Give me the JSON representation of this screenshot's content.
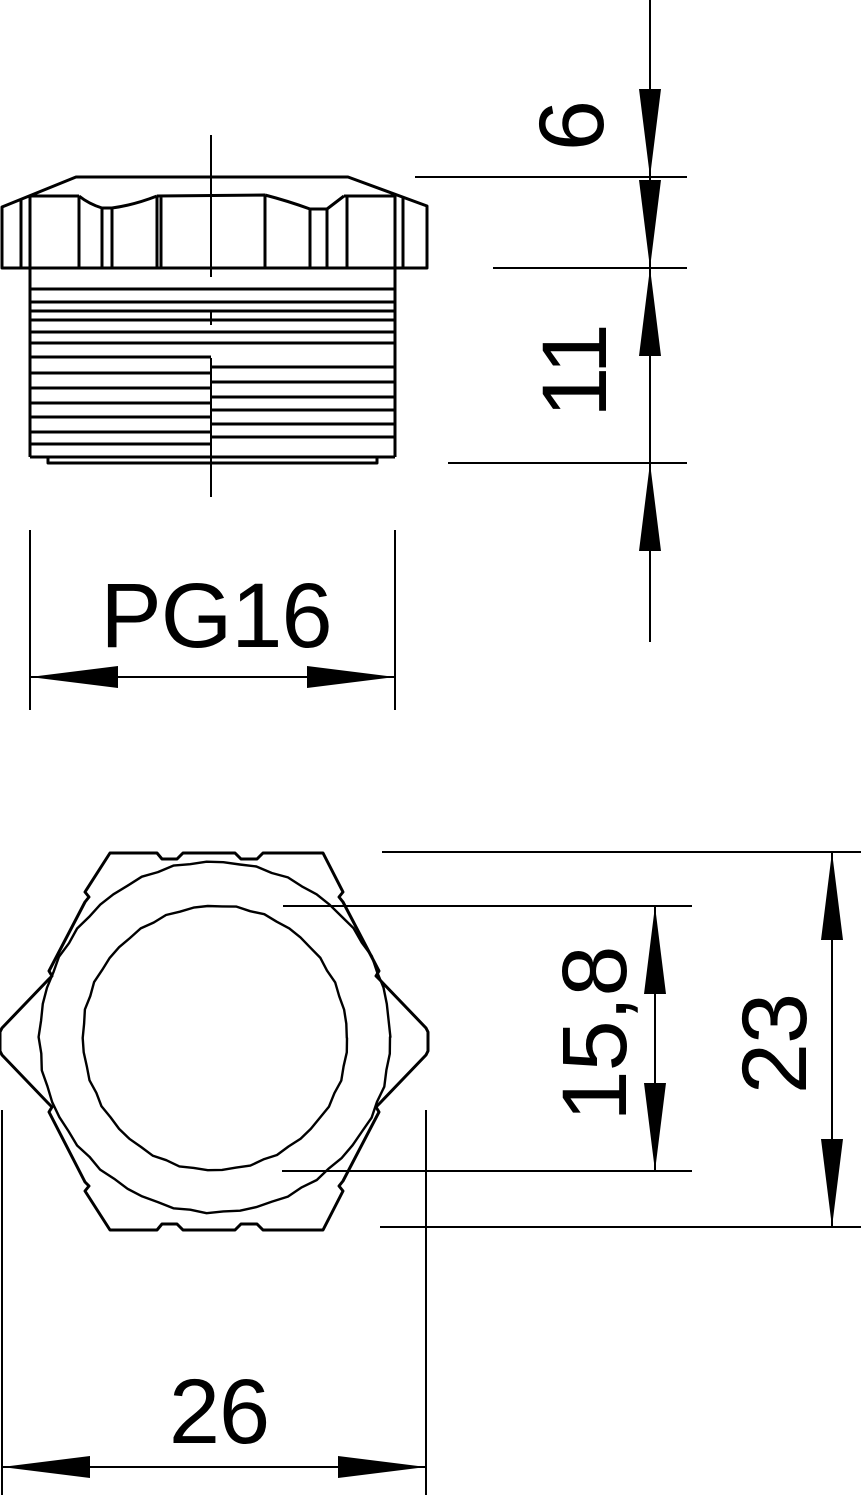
{
  "page": {
    "background": "#ffffff",
    "line_color": "#000000"
  },
  "drawing": {
    "labels": {
      "thread_size": "PG16",
      "head_height": "6",
      "thread_length": "11",
      "inner_diameter": "15,8",
      "across_flats": "23",
      "outer_diameter": "26"
    }
  },
  "geometry": {
    "arrow": {
      "length": 88,
      "half_width": 11
    },
    "side_view": {
      "head_outline": "M2,207 L76,177 L348,177 L427,206 L427,268 L2,268 Z",
      "crown_detail": "M21,200 L21,268 M30,196 L30,268 M30,196 L79,196 M79,196 L79,268 M79,196 Q89,204 102,208 M102,208 L102,268 M102,208 L112,208 M112,208 L112,268 M112,208 Q134,205 157,196 M157,196 L157,268 M161,196 L161,268 M157,196 L265,195 M265,195 L265,268 M265,195 Q288,201 310,209 M310,209 L310,268 M310,209 L327,209 M327,209 L327,268 M327,209 L344,196 M344,196 L347,196 M347,196 L347,268 M344,196 L395,196 M395,194 L395,268 M403,197 L403,268",
      "body_outline": "M30,268 L30,457 M395,268 L395,457 M30,457 L395,457 M48,457 L48,463 L377,463 L377,457",
      "threads": {
        "full": {
          "x1": 30,
          "x2": 395,
          "ys": [
            289,
            302,
            311,
            320,
            332,
            343
          ]
        },
        "left": {
          "x1": 30,
          "x2": 211,
          "ys": [
            357,
            373,
            388,
            403,
            417,
            432,
            444
          ]
        },
        "right": {
          "x1": 211,
          "x2": 395,
          "ys": [
            367,
            382,
            397,
            410,
            424,
            437
          ]
        }
      },
      "centerline": {
        "x": 211,
        "segments": [
          [
            135,
            277
          ],
          [
            310,
            325
          ],
          [
            358,
            497
          ]
        ]
      }
    },
    "front_view": {
      "hex_outline": "M110,853 L157,853 L162,859 L177,859 L183,853 L235,853 L241,859 L257,859 L263,853 L323,853 L343,892 L339,897 L343,902 L379,971 L376,976 L380,980 L426,1028 L428,1032 L428,1051 L426,1055 L380,1103 L376,1107 L379,1112 L343,1181 L339,1186 L343,1191 L323,1230 L263,1230 L257,1224 L241,1224 L235,1230 L183,1230 L177,1224 L162,1224 L157,1230 L110,1230 L85,1191 L89,1186 L85,1182 L49,1112 L52,1107 L48,1103 L2,1055 L0,1051 L0,1032 L2,1028 L48,980 L52,976 L49,971 L85,902 L89,897 L85,892 Z",
      "outer_circle": {
        "cx": 215,
        "cy": 1037,
        "r": 175,
        "segments": 66,
        "wobble": 1.5
      },
      "inner_circle": {
        "cx": 215,
        "cy": 1038,
        "r": 132,
        "segments": 58,
        "wobble": 1.3
      }
    },
    "dimensions": [
      {
        "name": "dimension-6-11",
        "line": {
          "x1": 650,
          "y1": 0,
          "x2": 650,
          "y2": 642
        },
        "exts": [
          [
            415,
            177,
            687,
            177
          ],
          [
            493,
            268,
            687,
            268
          ],
          [
            448,
            463,
            687,
            463
          ]
        ],
        "arrows": [
          {
            "x": 650,
            "y": 177,
            "dir": "down"
          },
          {
            "x": 650,
            "y": 268,
            "dir": "down"
          },
          {
            "x": 650,
            "y": 268,
            "dir": "up"
          },
          {
            "x": 650,
            "y": 463,
            "dir": "up"
          }
        ]
      },
      {
        "name": "dimension-pg16",
        "line": {
          "x1": 30,
          "y1": 677,
          "x2": 395,
          "y2": 677
        },
        "exts": [
          [
            30,
            530,
            30,
            710
          ],
          [
            395,
            530,
            395,
            710
          ]
        ],
        "arrows": [
          {
            "x": 30,
            "y": 677,
            "dir": "left"
          },
          {
            "x": 395,
            "y": 677,
            "dir": "right"
          }
        ]
      },
      {
        "name": "dimension-15-8",
        "line": {
          "x1": 655,
          "y1": 906,
          "x2": 655,
          "y2": 1171
        },
        "exts": [
          [
            283,
            906,
            692,
            906
          ],
          [
            282,
            1171,
            692,
            1171
          ]
        ],
        "arrows": [
          {
            "x": 655,
            "y": 906,
            "dir": "up"
          },
          {
            "x": 655,
            "y": 1171,
            "dir": "down"
          }
        ]
      },
      {
        "name": "dimension-23",
        "line": {
          "x1": 832,
          "y1": 852,
          "x2": 832,
          "y2": 1227
        },
        "exts": [
          [
            382,
            852,
            861,
            852
          ],
          [
            380,
            1227,
            861,
            1227
          ]
        ],
        "arrows": [
          {
            "x": 832,
            "y": 852,
            "dir": "up"
          },
          {
            "x": 832,
            "y": 1227,
            "dir": "down"
          }
        ]
      },
      {
        "name": "dimension-26",
        "line": {
          "x1": 2,
          "y1": 1467,
          "x2": 426,
          "y2": 1467
        },
        "exts": [
          [
            2,
            1110,
            2,
            1495
          ],
          [
            426,
            1110,
            426,
            1495
          ]
        ],
        "arrows": [
          {
            "x": 2,
            "y": 1467,
            "dir": "left"
          },
          {
            "x": 426,
            "y": 1467,
            "dir": "right"
          }
        ]
      }
    ]
  }
}
